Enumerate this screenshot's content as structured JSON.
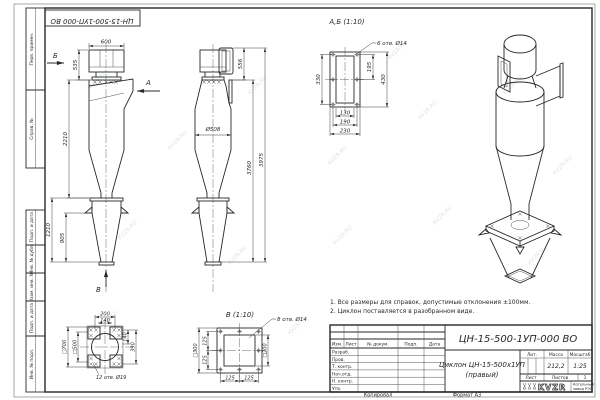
{
  "watermark": {
    "text": "KVZR.RU"
  },
  "frame": {
    "stamp": "ЦН-15-500-1УП-000 ВО",
    "left_strip": {
      "perv": "Перв. примен.",
      "sprav": "Справ. №",
      "podp1": "Подп. и дата",
      "inv_dubl": "Инв. № дубл.",
      "vzam": "Взам. инв. №",
      "podp2": "Подп. и дата",
      "inv_podl": "Инв. № подл."
    },
    "footer": {
      "kopiroval": "Копировал",
      "format": "Формат А3"
    }
  },
  "front_view": {
    "arrow_b": "Б",
    "arrow_a": "А",
    "arrow_v": "В",
    "dims": {
      "d600": "600",
      "d535": "535",
      "d2210": "2210",
      "d1210": "1210",
      "d905": "905"
    }
  },
  "side_view": {
    "dims": {
      "d556": "556",
      "d508": "Ø508",
      "d3760": "3760",
      "d3975": "3975"
    }
  },
  "section_ab": {
    "title": "А,Б (1:10)",
    "holes": "6 отв. Ø14",
    "dims": {
      "d330": "330",
      "d195": "195",
      "d430": "430",
      "d130": "130",
      "d190": "190",
      "d230": "230"
    }
  },
  "view_v": {
    "title": "В (1:10)",
    "holes": "8 отв. Ø14",
    "dims": {
      "sq300": "□300",
      "d125a": "125",
      "d125b": "125",
      "d125c": "125",
      "d125d": "125",
      "sq200": "□200"
    }
  },
  "detail_bottom": {
    "holes": "12 отв. Ø19",
    "dims": {
      "d200": "200",
      "d140t": "140",
      "d140r": "140",
      "d390": "390",
      "sq700": "□700",
      "sq500": "□500"
    }
  },
  "notes": {
    "line1": "1. Все размеры для справок, допустимые отклонения ±100мм.",
    "line2": "2. Циклон поставляется в разобранном виде."
  },
  "title_block": {
    "doc_number": "ЦН-15-500-1УП-000 ВО",
    "name_line1": "Циклон ЦН-15-500х1УП",
    "name_line2": "(правый)",
    "cols": {
      "izm": "Изм.",
      "list": "Лист",
      "ndoc": "№ докум.",
      "podp": "Подп.",
      "data": "Дата"
    },
    "rows": {
      "razrab": "Разраб.",
      "prov": "Пров.",
      "tkontr": "Т. контр.",
      "nachotd": "Нач.отд.",
      "nkontr": "Н. контр.",
      "utv": "Утв."
    },
    "lit": "Лит.",
    "massa": "Масса",
    "masshtab": "Масштаб",
    "massa_value": "212,2",
    "scale_value": "1:25",
    "list_label": "Лист",
    "listov_label": "Листов",
    "listov_value": "1",
    "logo": {
      "text": "KVZR",
      "sub1": "Котельный",
      "sub2": "завод РЭП"
    }
  }
}
